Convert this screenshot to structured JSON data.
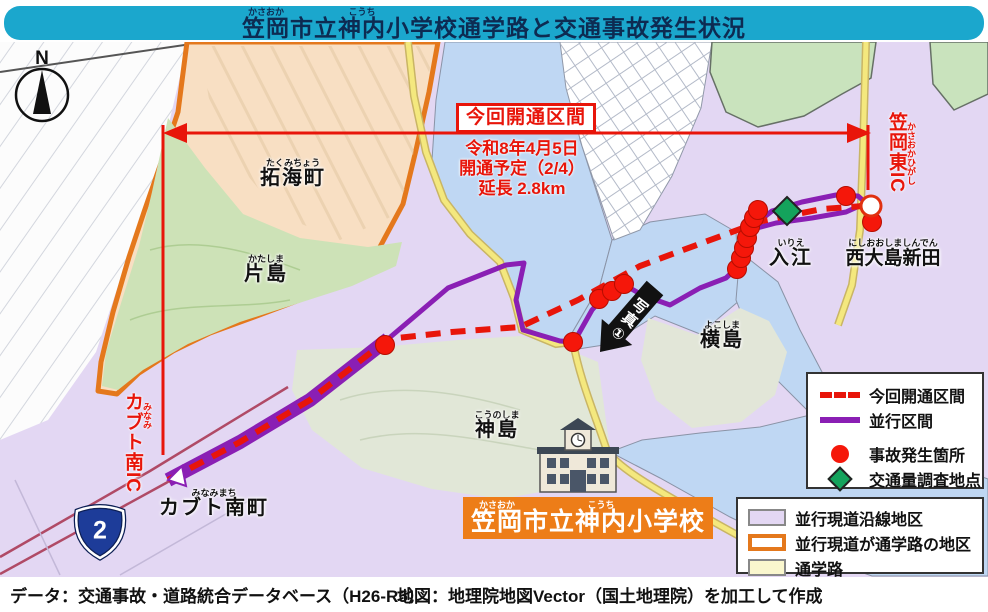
{
  "title": {
    "segments": [
      {
        "t": "笠岡",
        "f": "かさおか"
      },
      {
        "t": "市立",
        "f": ""
      },
      {
        "t": "神内",
        "f": "こうち"
      },
      {
        "t": "小学校通学路と交通事故発生状況",
        "f": ""
      }
    ]
  },
  "annotations": {
    "opening_section_label": "今回開通区間",
    "opening_details": [
      "令和8年4月5日",
      "開通予定（2/4）",
      "延長 2.8km"
    ],
    "photo_arrow_label": "写真①"
  },
  "places": {
    "takumicho": {
      "t": "拓海町",
      "f": "たくみちょう"
    },
    "katashima": {
      "t": "片島",
      "f": "かたしま"
    },
    "kabuto_minami_ic": {
      "t": "カブト南IC",
      "f": "みなみ"
    },
    "kabuto_minamimachi": {
      "t": "カブト南町",
      "f": "みなみまち"
    },
    "kounoshima": {
      "t": "神島",
      "f": "こうのしま"
    },
    "yokoshima": {
      "t": "横島",
      "f": "よこしま"
    },
    "irie": {
      "t": "入江",
      "f": "いりえ"
    },
    "nishiooshimashinden": {
      "t": "西大島新田",
      "f": "にしおおしましんでん"
    },
    "kasaoka_higashi_ic": {
      "t": "笠岡東IC",
      "f": "かさおかひがし"
    }
  },
  "school_label": {
    "segments": [
      {
        "t": "笠岡",
        "f": "かさおか"
      },
      {
        "t": "市立",
        "f": ""
      },
      {
        "t": "神内",
        "f": "こうち"
      },
      {
        "t": "小学校",
        "f": ""
      }
    ]
  },
  "route_badge": {
    "number": "2"
  },
  "compass": {
    "label": "N"
  },
  "legend_lines": {
    "items": [
      {
        "label": "今回開通区間",
        "style": "red-dashed-line"
      },
      {
        "label": "並行区間",
        "style": "purple-line"
      },
      {
        "label": "事故発生箇所",
        "style": "red-dot"
      },
      {
        "label": "交通量調査地点",
        "style": "green-diamond"
      }
    ]
  },
  "legend_areas": {
    "items": [
      {
        "label": "並行現道沿線地区",
        "swatch": "lavender-fill"
      },
      {
        "label": "並行現道が通学路の地区",
        "swatch": "orange-outline"
      },
      {
        "label": "通学路",
        "swatch": "yellow-fill"
      }
    ]
  },
  "footer": {
    "data_source": "データ：交通事故・道路統合データベース（H26-R5）",
    "map_source": "地図：地理院地図Vector（国土地理院）を加工して作成"
  },
  "colors": {
    "title_bar": "#1BA7CD",
    "title_text": "#0D2B52",
    "annotation_red": "#E8150A",
    "parallel_purple": "#8A1FB4",
    "area_lavender": "#E3D7F3",
    "area_peach": "#F8DFC3",
    "area_orange_border": "#E4781C",
    "water_blue": "#BFD7F3",
    "school_route_yellow": "#F4E87E",
    "hill_green": "#CDE2B7",
    "survey_diamond_green": "#14A35C",
    "route_badge_blue": "#1D3C99",
    "school_label_orange": "#ED7D18"
  }
}
